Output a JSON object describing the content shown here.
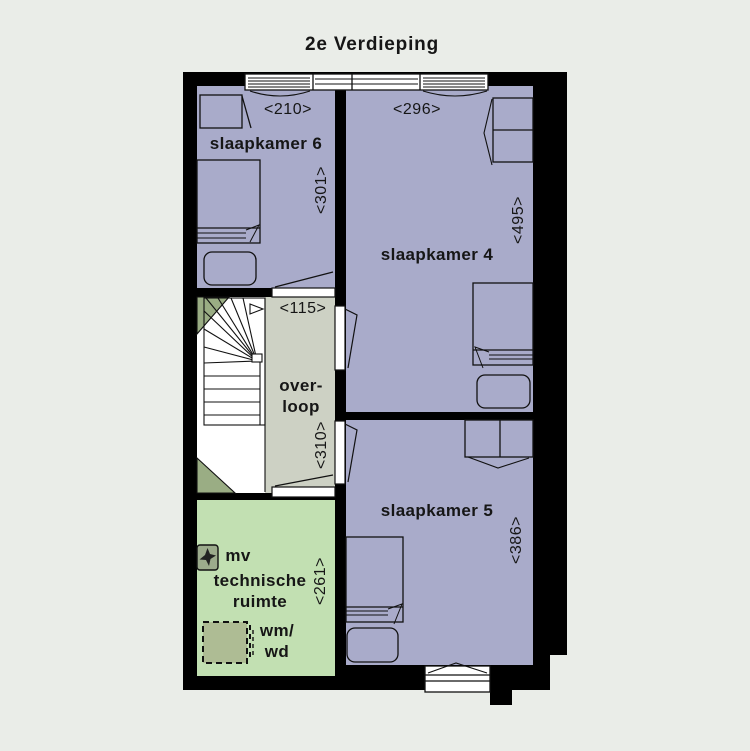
{
  "title": "2e Verdieping",
  "floor_plan": {
    "rooms": {
      "slaapkamer6": {
        "label": "slaapkamer 6",
        "width_dim": "<210>",
        "depth_dim": "<301>"
      },
      "slaapkamer4": {
        "label": "slaapkamer 4",
        "width_dim": "<296>",
        "depth_dim": "<495>"
      },
      "slaapkamer5": {
        "label": "slaapkamer 5",
        "depth_dim": "<386>"
      },
      "overloop": {
        "label_line1": "over-",
        "label_line2": "loop",
        "width_dim": "<115>",
        "depth_dim": "<310>"
      },
      "technische_ruimte": {
        "label_line1": "technische",
        "label_line2": "ruimte",
        "depth_dim": "<261>",
        "mv_label": "mv",
        "wm_wd_line1": "wm/",
        "wm_wd_line2": "wd"
      }
    },
    "colors": {
      "background": "#eaede8",
      "bedroom_fill": "#a9abca",
      "landing_fill": "#cdd1c4",
      "technical_fill": "#c2e0b2",
      "stair_accent_fill": "#9aad84",
      "mv_unit_fill": "#9cab8c",
      "washer_fill": "#aebc94",
      "wall": "#000000",
      "text": "#161616"
    }
  }
}
